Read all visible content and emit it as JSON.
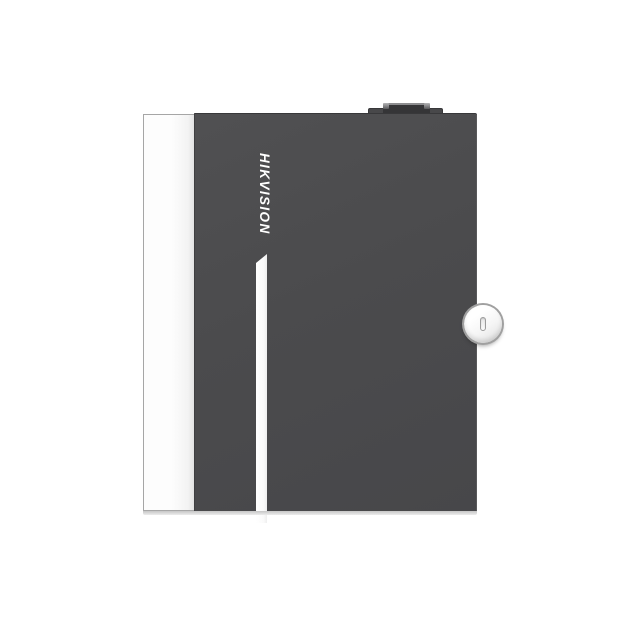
{
  "product": {
    "brand_label": "HIKVISION"
  },
  "colors": {
    "background": "#ffffff",
    "door": "#4b4b4d",
    "door_edge": "#38383a",
    "panel_white": "#fdfdfd",
    "panel_border": "#a6a6a6",
    "stripe": "#fafafa",
    "logo_text": "#ffffff",
    "lock_face": "#f5f5f5",
    "lock_rim": "#a0a0a0",
    "tamper_block": "#353537",
    "base_line": "#c6c6c6"
  }
}
